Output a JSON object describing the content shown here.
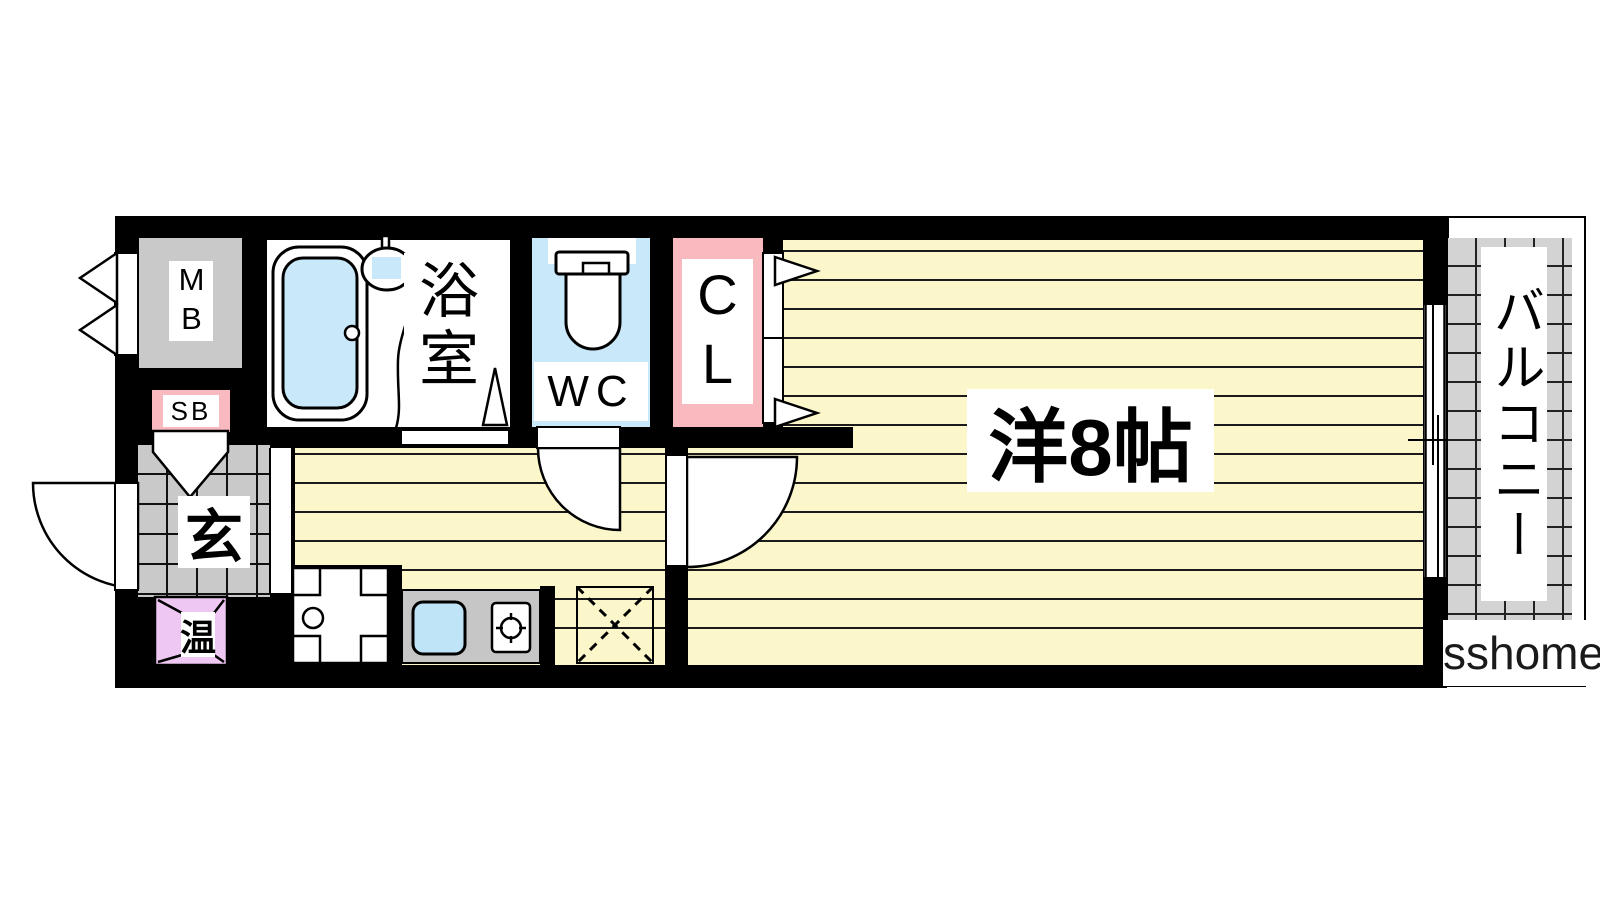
{
  "plan": {
    "meter_box_label": "MB",
    "bathroom_label": "浴室",
    "wc_label": "WC",
    "closet_label": "CL",
    "shoe_box_label": "SB",
    "entrance_label": "玄",
    "water_heater_label": "温",
    "main_room_label": "洋8帖",
    "balcony_label": "バルコニー",
    "watermark": "sshome"
  },
  "icons": [
    "bathtub-icon",
    "shower-icon",
    "toilet-icon",
    "sink-icon",
    "stove-burner-icon",
    "washing-machine-pan-icon",
    "refrigerator-space-icon",
    "door-swing-icon",
    "sliding-window-icon",
    "closet-door-arrow-icon",
    "water-heater-icon"
  ],
  "colors": {
    "floor_yellow": "#FCF7CB",
    "water_blue": "#C9E9FA",
    "closet_pink": "#F9BABF",
    "heater_lavender": "#EEC8F2",
    "tile_gray": "#C9C9C9",
    "counter_gray": "#C6C6C6",
    "wall_black": "#000000"
  }
}
